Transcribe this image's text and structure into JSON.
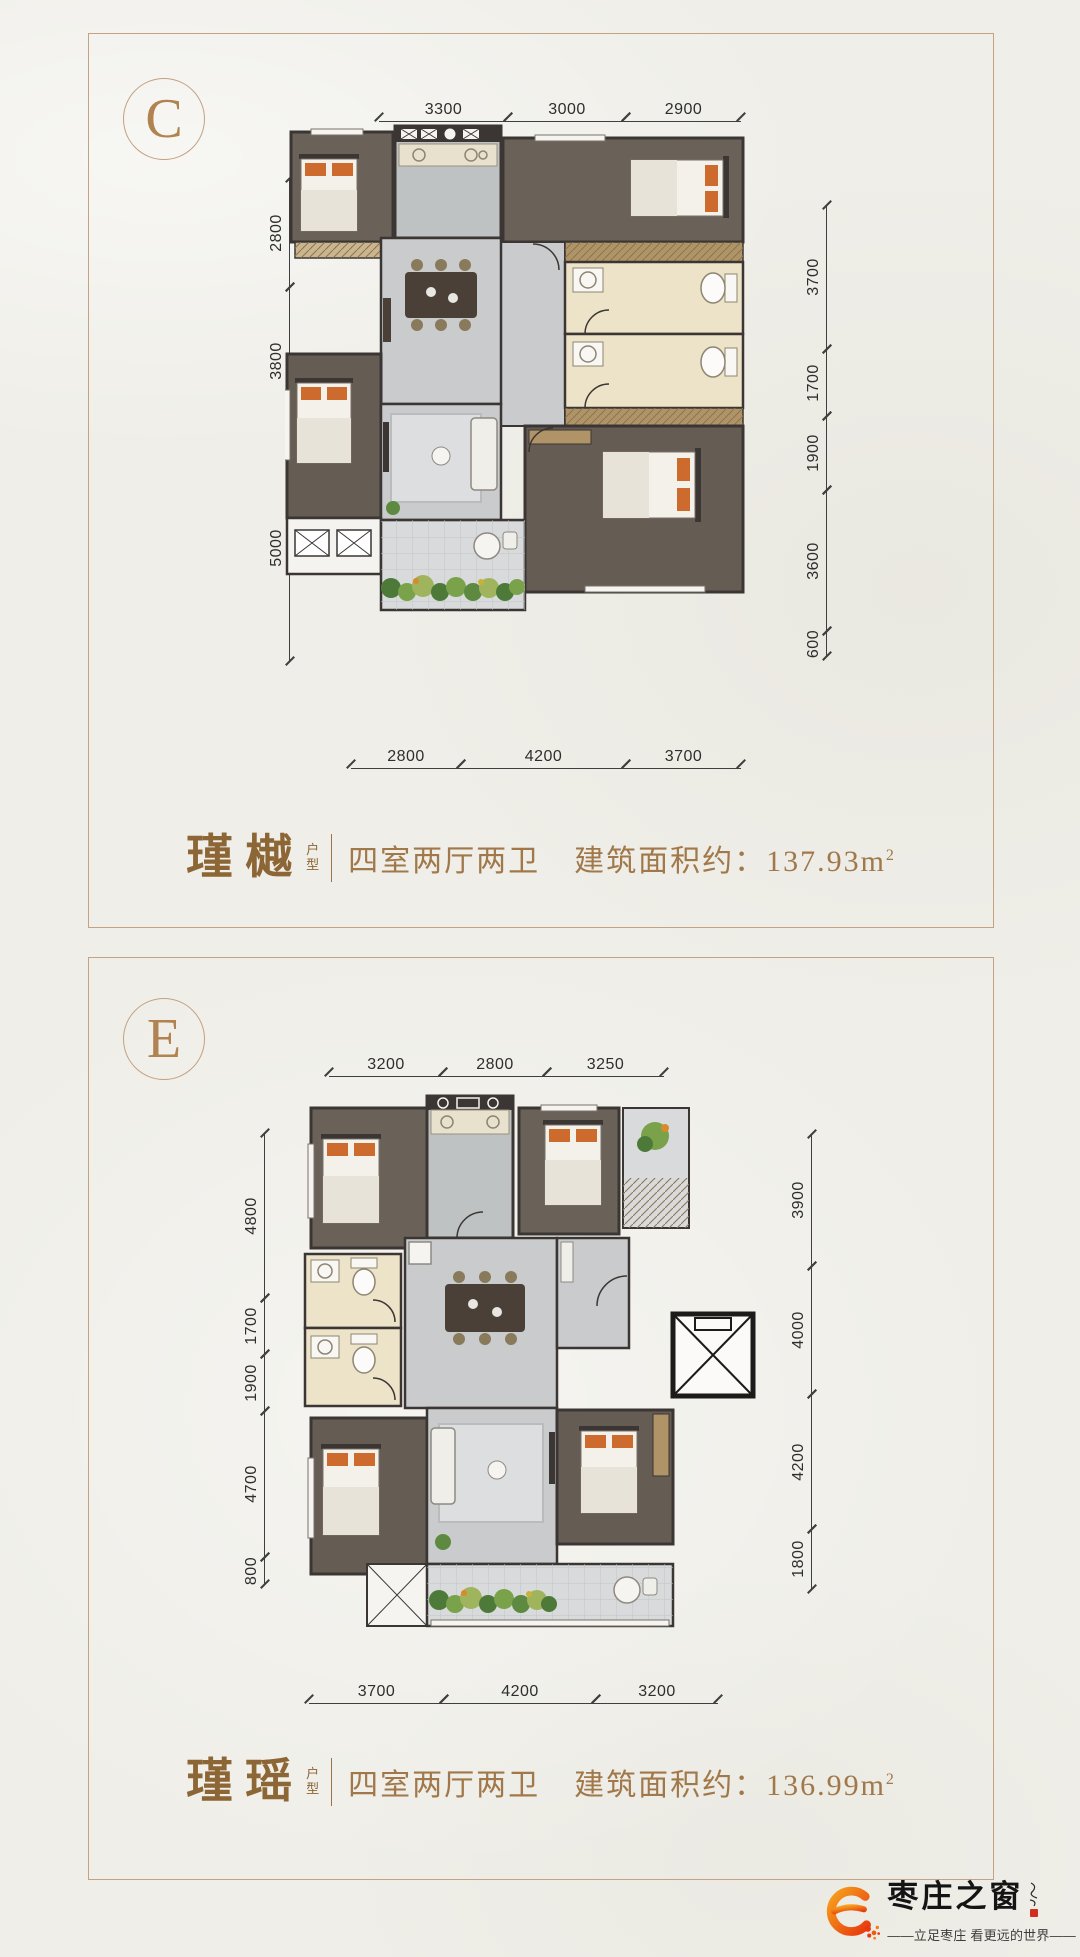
{
  "colors": {
    "paper": "#efeee8",
    "panel_border": "#c4a284",
    "accent_brown": "#9c7445",
    "wall_dark": "#3b3633",
    "bedroom_floor": "#6a6159",
    "light_floor": "#c9cbcc",
    "bath_floor": "#ece3c9",
    "pillow_orange": "#cd6a2d",
    "logo_orange": "#f59120",
    "logo_red": "#e8380d"
  },
  "panels": [
    {
      "label": "C",
      "unit_name": "瑾樾",
      "unit_type": "户型",
      "rooms": "四室两厅两卫",
      "area_label": "建筑面积约：",
      "area_value": "137.93",
      "area_unit": "m",
      "area_exp": "2",
      "dims_top": [
        "3300",
        "3000",
        "2900"
      ],
      "dims_left": [
        "2800",
        "3800",
        "5000"
      ],
      "dims_right": [
        "3700",
        "1700",
        "1900",
        "3600",
        "600"
      ],
      "dims_bottom": [
        "2800",
        "4200",
        "3700"
      ]
    },
    {
      "label": "E",
      "unit_name": "瑾瑶",
      "unit_type": "户型",
      "rooms": "四室两厅两卫",
      "area_label": "建筑面积约：",
      "area_value": "136.99",
      "area_unit": "m",
      "area_exp": "2",
      "dims_top": [
        "3200",
        "2800",
        "3250"
      ],
      "dims_left": [
        "4800",
        "1700",
        "1900",
        "4700",
        "800"
      ],
      "dims_right": [
        "3900",
        "4000",
        "4200",
        "1800"
      ],
      "dims_bottom": [
        "3700",
        "4200",
        "3200"
      ]
    }
  ],
  "footer": {
    "brand": "枣庄之窗",
    "tagline": "——立足枣庄 看更远的世界——"
  }
}
